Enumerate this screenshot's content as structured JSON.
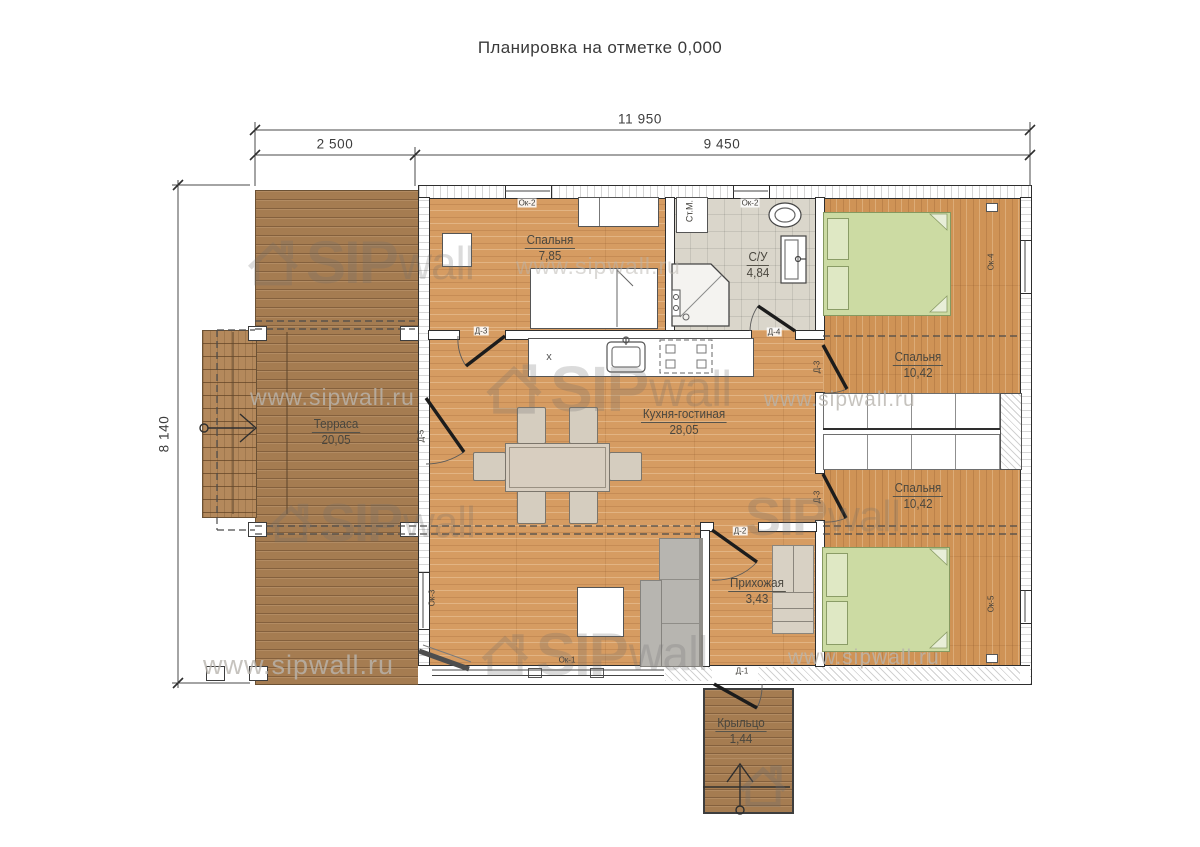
{
  "title": "Планировка на отметке 0,000",
  "dimensions": {
    "total_width": "11 950",
    "terrace_width": "2 500",
    "house_width": "9 450",
    "height": "8 140"
  },
  "rooms": {
    "bedroom1": {
      "name": "Спальня",
      "area": "7,85"
    },
    "bathroom": {
      "name": "С/У",
      "area": "4,84"
    },
    "bedroom2": {
      "name": "Спальня",
      "area": "10,42"
    },
    "bedroom3": {
      "name": "Спальня",
      "area": "10,42"
    },
    "kitchen_living": {
      "name": "Кухня-гостиная",
      "area": "28,05"
    },
    "terrace": {
      "name": "Терраса",
      "area": "20,05"
    },
    "hallway": {
      "name": "Прихожая",
      "area": "3,43"
    },
    "porch": {
      "name": "Крыльцо",
      "area": "1,44"
    }
  },
  "doors": {
    "d1": "Д-1",
    "d2": "Д-2",
    "d3": "Д-3",
    "d4": "Д-4",
    "d5": "Д-5"
  },
  "windows": {
    "ok1": "Ок-1",
    "ok2": "Ок-2",
    "ok3": "Ок-3",
    "ok4": "Ок-4",
    "ok5": "Ок-5"
  },
  "labels": {
    "washing_machine": "Ст.М.",
    "stove_mark": "x"
  },
  "watermark": {
    "brand_sip": "SIP",
    "brand_wall": "wall",
    "url": "www.sipwall.ru"
  },
  "colors": {
    "floor_wood": "#d69c62",
    "terrace_wood": "#a57c51",
    "tile": "#dad6cb",
    "bed_green": "#ccdba3",
    "line": "#2e2e2e"
  }
}
